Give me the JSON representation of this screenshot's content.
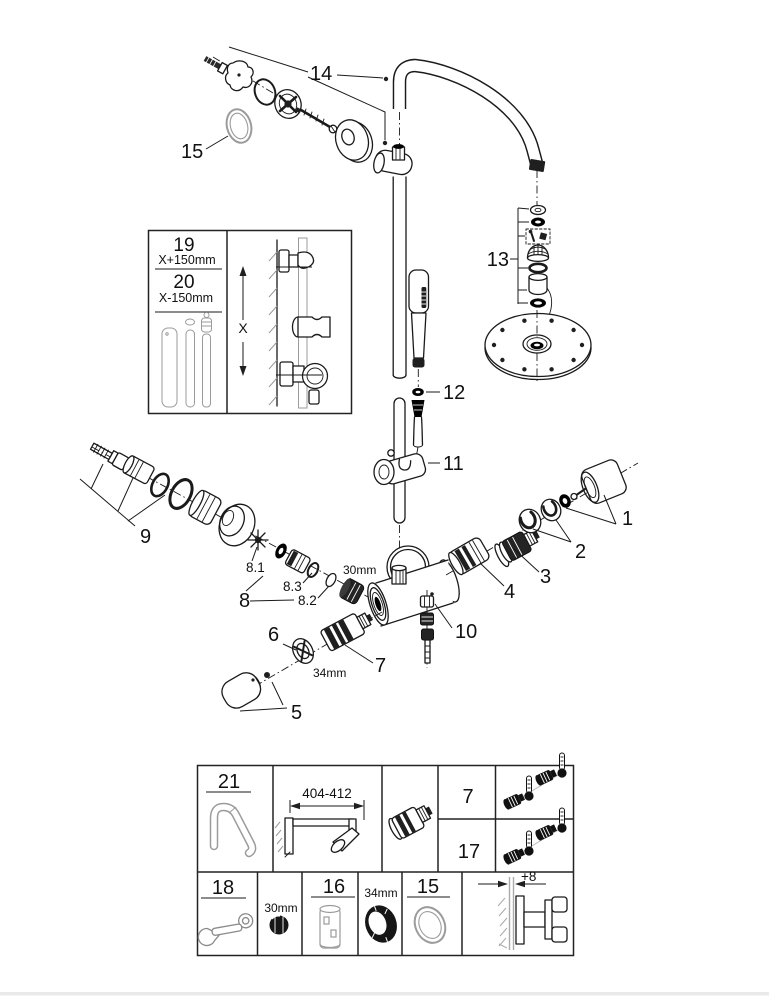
{
  "figure": {
    "alt": "Exploded spare-parts diagram of a thermostatic shower system"
  },
  "callouts": {
    "c1": "1",
    "c2": "2",
    "c3": "3",
    "c4": "4",
    "c5": "5",
    "c6": "6",
    "c7": "7",
    "c8": "8",
    "c8_1": "8.1",
    "c8_2": "8.2",
    "c8_3": "8.3",
    "c9": "9",
    "c10": "10",
    "c11": "11",
    "c12": "12",
    "c13": "13",
    "c14": "14",
    "c15": "15"
  },
  "sizes": {
    "s30": "30mm",
    "s34": "34mm"
  },
  "inset": {
    "n19": "19",
    "d19": "X+150mm",
    "n20": "20",
    "d20": "X-150mm",
    "x": "X"
  },
  "table": {
    "n21": "21",
    "d404": "404-412",
    "n7": "7",
    "n17": "17",
    "n18": "18",
    "s30": "30mm",
    "n16": "16",
    "s34": "34mm",
    "n15": "15",
    "d8": "+8"
  }
}
